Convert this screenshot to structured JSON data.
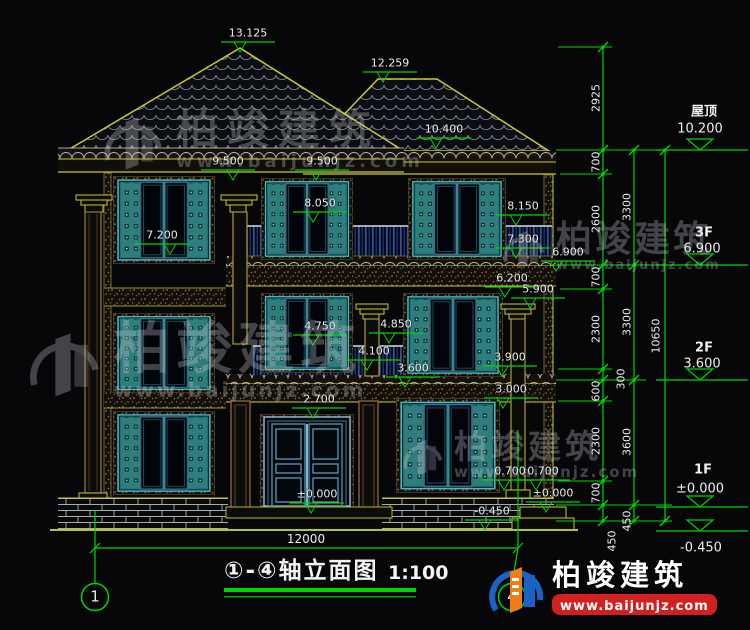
{
  "drawing": {
    "footer": {
      "title": "①-④轴立面图",
      "scale": "1:100",
      "overall_width": "12000",
      "axis_left": "1",
      "axis_right": "4"
    },
    "levels": [
      {
        "name": "屋顶",
        "value": "10.200"
      },
      {
        "name": "3F",
        "value": "6.900"
      },
      {
        "name": "2F",
        "value": "3.600"
      },
      {
        "name": "1F",
        "value": "±0.000"
      },
      {
        "name": "",
        "value": "-0.450"
      }
    ],
    "elevation_marks": [
      "13.125",
      "12.259",
      "10.400",
      "9.500",
      "9.500",
      "8.150",
      "8.050",
      "7.300",
      "7.200",
      "6.900",
      "6.200",
      "5.900",
      "4.850",
      "4.750",
      "4.100",
      "3.900",
      "3.600",
      "3.000",
      "2.700",
      "0.700",
      "0.700",
      "±0.000",
      "±0.000",
      "-0.450"
    ],
    "dim_chains": {
      "inner": [
        "2925",
        "700",
        "2600",
        "700",
        "2300",
        "300",
        "600",
        "2300",
        "700",
        "450"
      ],
      "middle": [
        "3300",
        "3300",
        "3600",
        "450"
      ],
      "outer": [
        "10650"
      ]
    }
  },
  "watermark": {
    "brand": "柏竣建筑",
    "url": "www.baijunjz.com"
  },
  "logo": {
    "brand": "柏竣建筑",
    "url": "www.baijunjz.com"
  },
  "colors": {
    "dim_green": "#00d400",
    "cad_yellow": "#c9c832",
    "teal_shutter": "#2e7e7e",
    "brand_blue": "#1a63c6",
    "brand_orange": "#ef7d1a",
    "brand_red": "#d21f1f"
  }
}
